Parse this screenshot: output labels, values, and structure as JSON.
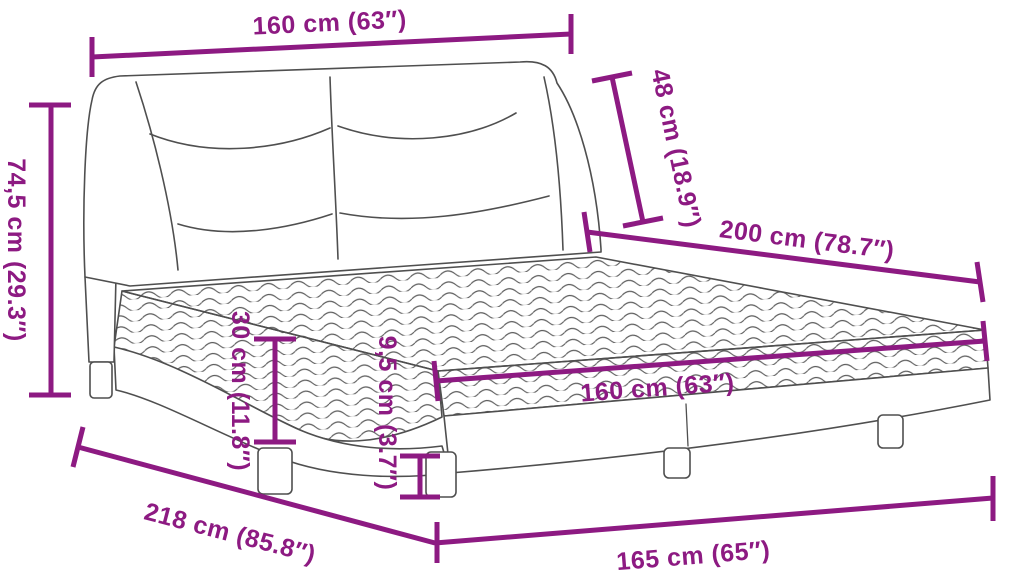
{
  "diagram": {
    "type": "product-dimension-diagram",
    "subject": "upholstered bed with headboard and mattress",
    "accent_color": "#8D1A82",
    "outline_color": "#4f4f4f",
    "background_color": "#ffffff",
    "labels": {
      "headboard_width": "160 cm (63″)",
      "headboard_height": "48 cm (18.9″)",
      "overall_height": "74,5 cm (29.3″)",
      "bed_length": "200 cm (78.7″)",
      "frame_height": "30 cm (11.8″)",
      "leg_height": "9,5 cm (3.7″)",
      "mattress_width": "160 cm (63″)",
      "overall_depth": "218 cm (85.8″)",
      "overall_width": "165 cm (65″)"
    }
  }
}
